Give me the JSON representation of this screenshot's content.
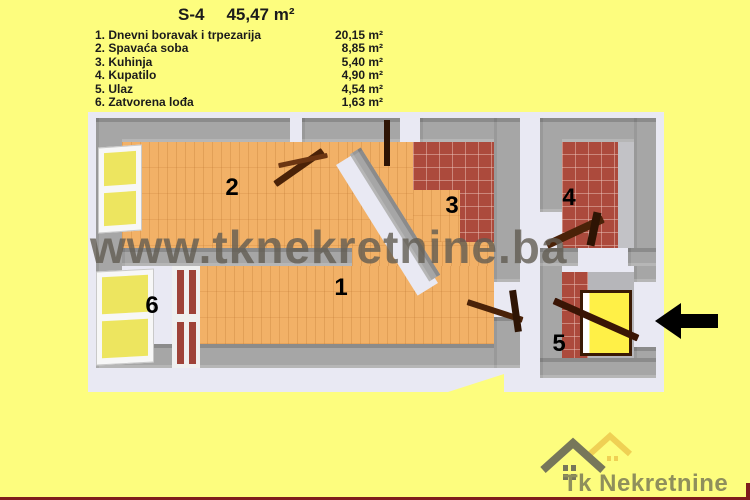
{
  "title": {
    "unit": "S-4",
    "total_area": "45,47 m²"
  },
  "legend": {
    "rooms": [
      {
        "num": "1",
        "label": "1. Dnevni boravak i trpezarija",
        "area": "20,15 m²"
      },
      {
        "num": "2",
        "label": "2. Spavaća soba",
        "area": "8,85 m²"
      },
      {
        "num": "3",
        "label": "3. Kuhinja",
        "area": "5,40 m²"
      },
      {
        "num": "4",
        "label": "4. Kupatilo",
        "area": "4,90 m²"
      },
      {
        "num": "5",
        "label": "5. Ulaz",
        "area": "4,54 m²"
      },
      {
        "num": "6",
        "label": "6. Zatvorena lođa",
        "area": "1,63 m²"
      }
    ]
  },
  "watermark": {
    "text": "www.tknekretnine.ba"
  },
  "logo": {
    "text": "Tk Nekretnine"
  },
  "colors": {
    "background": "#FDFD7E",
    "floor_orange": "#F2B167",
    "tile_red": "#AC4A3C",
    "wall_gray": "#A6A6A6",
    "plan_outline": "#E9E9F3",
    "window_yellow": "#EDE55F",
    "door_brown": "#4A2208",
    "arrow_black": "#000000",
    "logo_roof_gray": "#77775A",
    "logo_roof_yellow": "#EFD054",
    "logo_text": "#8F8F5C",
    "frame_bar_red": "#7E1D1D",
    "watermark_gray": "#625C53"
  }
}
